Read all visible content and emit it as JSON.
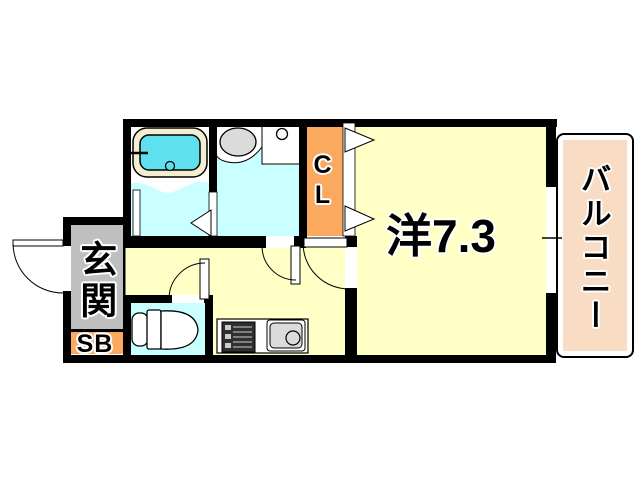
{
  "plan": {
    "title": "apartment-floor-plan",
    "labels": {
      "entrance": "玄関",
      "shoe_box": "SB",
      "closet": "CL",
      "western_room": "洋7.3",
      "balcony": "バルコニー"
    },
    "colors": {
      "room_yellow": "#FFFFC6",
      "wet_cyan": "#C9FFFF",
      "tub_cyan": "#5FE0EE",
      "tub_rim_cream": "#F3EDD2",
      "closet_orange": "#FBA95F",
      "balcony_peach": "#F8DCC4",
      "entrance_gray": "#BFBFBF",
      "fixture_gray": "#DBDBDB",
      "wall_black": "#000000"
    },
    "fixtures": [
      "bathtub-icon",
      "washbasin-icon",
      "washing-machine-pan-icon",
      "toilet-icon",
      "stove-icon",
      "kitchen-sink-icon",
      "door-swing-icon",
      "folding-door-icon",
      "window-icon"
    ]
  }
}
